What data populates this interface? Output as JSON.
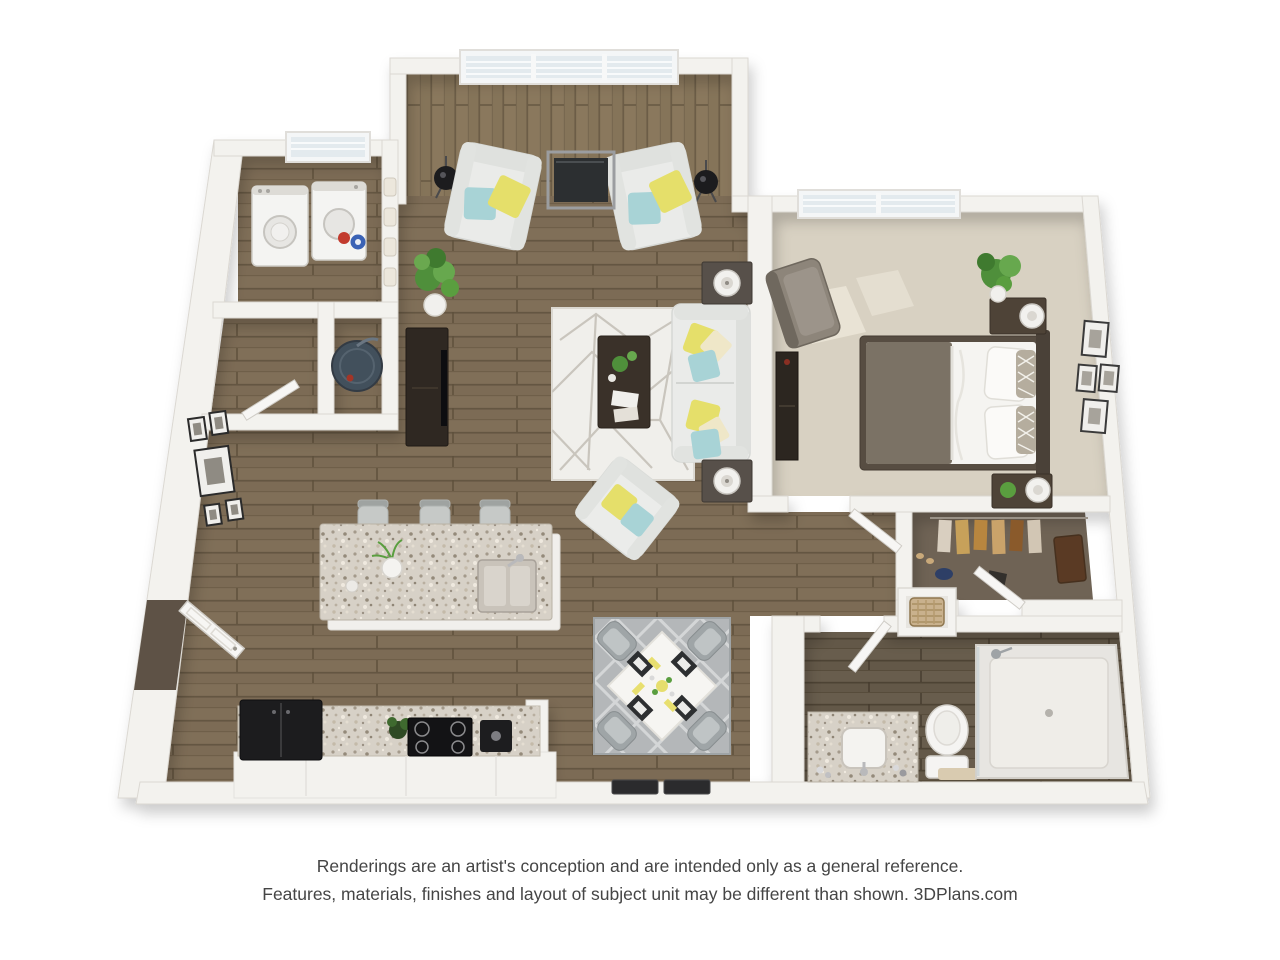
{
  "disclaimer": {
    "line1": "Renderings are an artist's conception and are intended only as a general reference.",
    "line2": "Features, materials, finishes and layout of subject unit may be different than shown. 3DPlans.com"
  },
  "plan": {
    "type": "3d-floor-plan-rendering",
    "rooms": [
      "sitting-area",
      "living-room",
      "kitchen",
      "dining-area",
      "bedroom",
      "bathroom",
      "walk-in-closet",
      "laundry-room",
      "entry-closet",
      "water-heater-closet",
      "hallway",
      "entry"
    ]
  },
  "palette": {
    "background": "#ffffff",
    "wall": "#f3f2ee",
    "wood_floor": "#7c6b55",
    "wood_floor_light": "#857459",
    "wood_floor_dark": "#635848",
    "bedroom_carpet": "#d8d1c2",
    "closet_carpet": "#6f6355",
    "granite": "#d7d1c7",
    "upholstery": "#eaebe9",
    "pillow_yellow": "#e5df6a",
    "pillow_teal": "#a8d3d6",
    "dark_wood": "#3a3129",
    "appliance_black": "#1c1c1e",
    "plant_green": "#4f8f3b",
    "text": "#454545"
  }
}
